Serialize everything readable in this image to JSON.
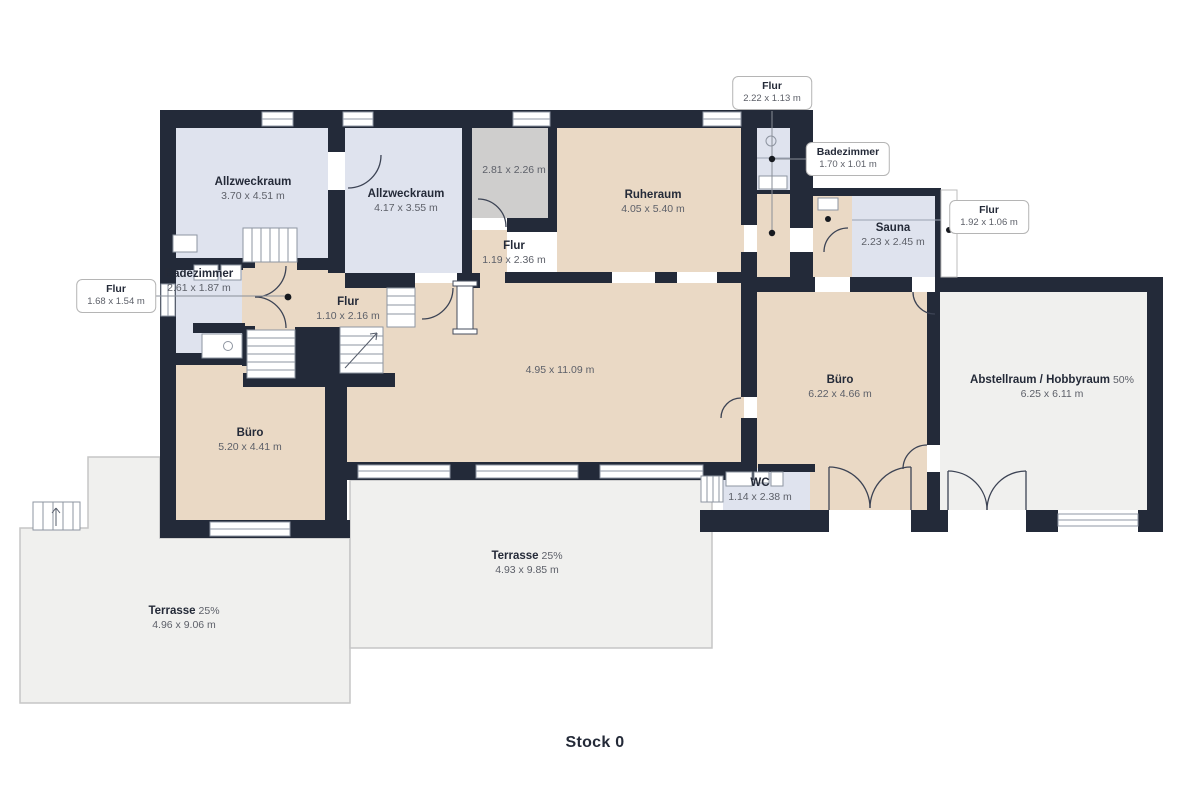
{
  "floor_label": "Stock 0",
  "rooms": {
    "allzweckraum_1": {
      "name": "Allzweckraum",
      "dims": "3.70 x 4.51 m"
    },
    "allzweckraum_2": {
      "name": "Allzweckraum",
      "dims": "4.17 x 3.55 m"
    },
    "storage_small": {
      "dims": "2.81 x 2.26 m"
    },
    "ruheraum": {
      "name": "Ruheraum",
      "dims": "4.05 x 5.40 m"
    },
    "flur_center": {
      "name": "Flur",
      "dims": "1.19 x 2.36 m"
    },
    "sauna": {
      "name": "Sauna",
      "dims": "2.23 x 2.45 m"
    },
    "main_room": {
      "dims": "4.95 x 11.09 m"
    },
    "flur_small": {
      "name": "Flur",
      "dims": "1.10 x 2.16 m"
    },
    "badezimmer_left": {
      "name": "Badezimmer",
      "dims": "2.61 x 1.87 m"
    },
    "buero_left": {
      "name": "Büro",
      "dims": "5.20 x 4.41 m"
    },
    "buero_right": {
      "name": "Büro",
      "dims": "6.22 x 4.66 m"
    },
    "wc": {
      "name": "WC",
      "dims": "1.14 x 2.38 m"
    },
    "abstellraum": {
      "name": "Abstellraum / Hobbyraum",
      "share": "50%",
      "dims": "6.25 x 6.11 m"
    },
    "terrasse_left": {
      "name": "Terrasse",
      "share": "25%",
      "dims": "4.96 x 9.06 m"
    },
    "terrasse_center": {
      "name": "Terrasse",
      "share": "25%",
      "dims": "4.93 x 9.85 m"
    }
  },
  "callouts": {
    "flur_top": {
      "name": "Flur",
      "dims": "2.22 x 1.13 m"
    },
    "badezimmer_top": {
      "name": "Badezimmer",
      "dims": "1.70 x 1.01 m"
    },
    "flur_right": {
      "name": "Flur",
      "dims": "1.92 x 1.06 m"
    },
    "flur_left": {
      "name": "Flur",
      "dims": "1.68 x 1.54 m"
    }
  },
  "colors": {
    "wall": "#232a39",
    "room_tan": "#ead9c5",
    "room_blue": "#dfe3ee",
    "room_gray": "#cfcecd",
    "terrace": "#f0f0ee",
    "label_dark": "#242a38",
    "label_gray": "#5d6069"
  }
}
